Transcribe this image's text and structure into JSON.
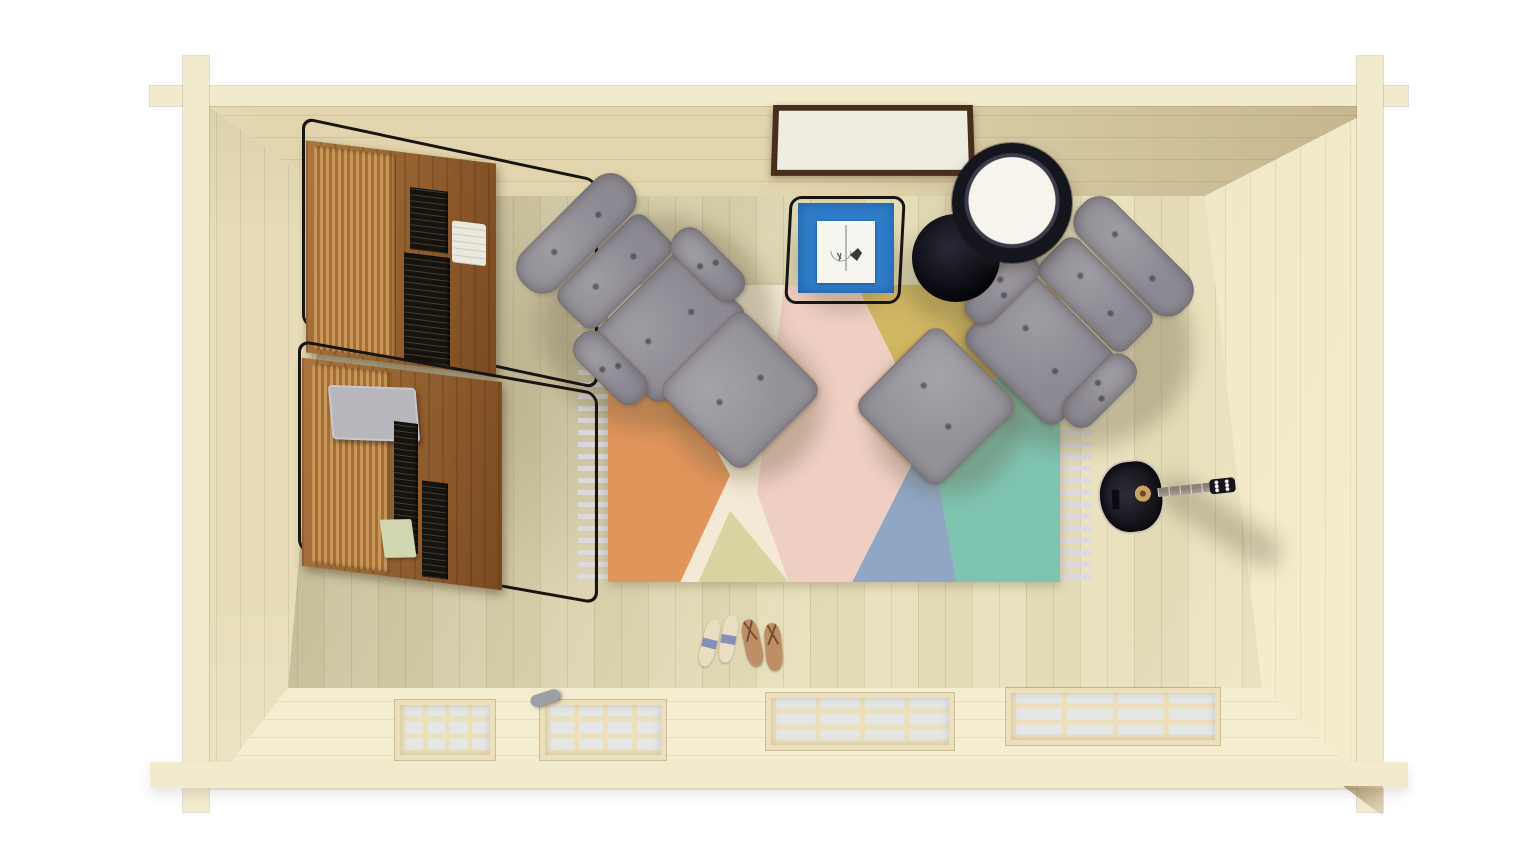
{
  "scene": {
    "description": "Top-down 3D render of a wooden log-cabin living room"
  },
  "colors": {
    "background": "#ffffff",
    "plate": "#f2eacd",
    "face_top": "#e2d5ad",
    "face_left": "#e7ddb9",
    "face_right": "#efe6c3",
    "face_bottom": "#f4edd0",
    "floor": "#e9e1bc",
    "shelf_wood": "#8f5a2b",
    "shelf_wood_light": "#bb8445",
    "wire_black": "#181510",
    "chair_gray": "#8d8992",
    "ottoman_gray": "#959199",
    "rug_cream": "#f3e9d4",
    "rug_orange": "#e1955b",
    "rug_pale_yellow": "#d9d3a2",
    "rug_pink": "#efcfc2",
    "rug_mustard": "#d2b763",
    "rug_blue": "#8fa6c4",
    "rug_teal": "#7fc3b1",
    "fringe": "#dcd9e2",
    "table_blue": "#2e7cc9",
    "paper": "#f7f5f0",
    "lamp_dark": "#15151e",
    "lamp_glow": "#f7f4ee",
    "guitar_body": "#16131b",
    "guitar_neck": "#8b8178",
    "guitar_hole": "#c8a266",
    "sandal": "#e9dec2",
    "sandal_strap": "#8591b4",
    "flipflop": "#bd8f67",
    "flipflop_strap": "#7c4b34",
    "poster_frame": "#46301c",
    "poster_mat": "#efece2",
    "poster_art_blue": "#3d4a80",
    "poster_figure_tan": "#d8b98a",
    "window_pane": "#e4e7e5",
    "window_muntin": "#ecdfb9",
    "book_dark": "#17140f",
    "laptop_gray": "#b7b6bd",
    "book_green": "#cfd6b0",
    "cloth_white": "#eae7dc",
    "handle_metal": "#9aa0a4"
  },
  "objects": {
    "bookshelf_top": {
      "label": "wall shelf with books",
      "spines": [
        "#c2452e",
        "#3aa08e",
        "#e0b13e",
        "#d8d2c4",
        "#c2452e",
        "#8db063",
        "#efe9dd",
        "#d4b84a",
        "#7fc0b0"
      ]
    },
    "bookshelf_bottom": {
      "label": "wall shelf with books and tablet",
      "spines": [
        "#c24a32",
        "#ded8cc",
        "#e08030",
        "#e0b13e",
        "#d67f8e",
        "#52b1a0",
        "#8db063",
        "#c24a32",
        "#efe9dd",
        "#3aa08e"
      ]
    },
    "poster": {
      "label": "framed wall poster"
    },
    "side_table": {
      "label": "blue side table with sketch paper"
    },
    "floor_lamp": {
      "label": "floor lamp"
    },
    "armchair_left": {
      "label": "gray tufted lounge chair"
    },
    "armchair_right": {
      "label": "gray tufted lounge chair"
    },
    "ottoman_left": {
      "label": "gray ottoman"
    },
    "ottoman_right": {
      "label": "gray ottoman"
    },
    "rug": {
      "label": "pastel diamond-pattern rug with fringe"
    },
    "guitar": {
      "label": "black acoustic guitar"
    },
    "sandals": {
      "label": "pair of slide sandals"
    },
    "flip_flops": {
      "label": "pair of flip flops"
    },
    "double_door": {
      "label": "glazed double door"
    },
    "window_left": {
      "label": "glazed window"
    },
    "window_right": {
      "label": "glazed window"
    }
  }
}
